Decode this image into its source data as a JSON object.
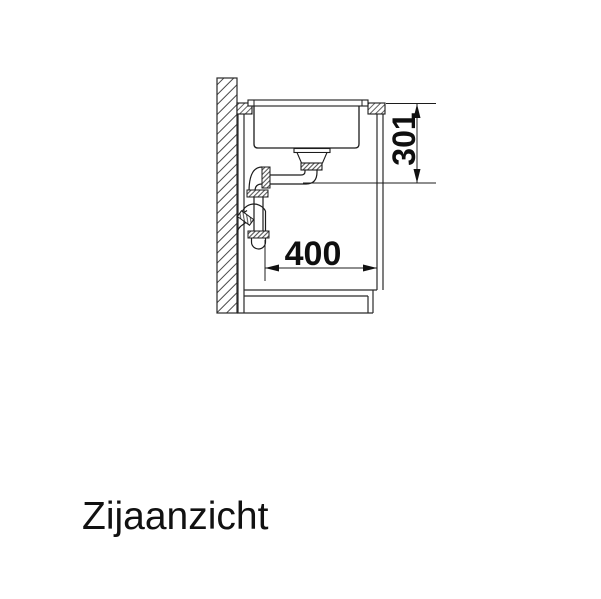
{
  "view": {
    "title": "Zijaanzicht"
  },
  "dimensions": {
    "vertical": "301",
    "horizontal": "400"
  },
  "colors": {
    "background": "#ffffff",
    "line": "#1c1c1c",
    "text": "#0f0f0f"
  }
}
